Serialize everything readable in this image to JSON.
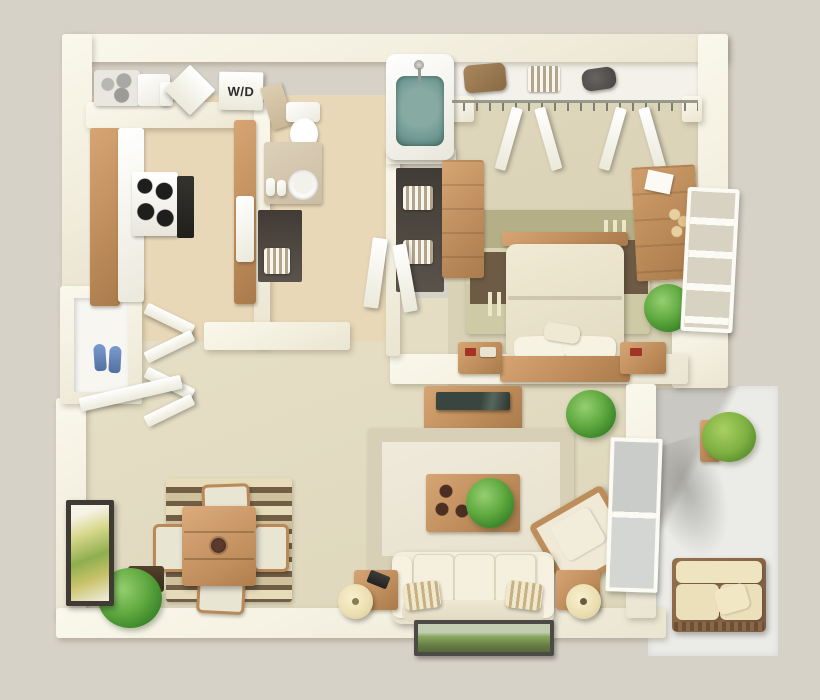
{
  "scene": {
    "title": "One-bedroom apartment 3D floor plan (bird's-eye render)",
    "labels": {
      "washer_dryer": "W/D"
    },
    "palette": {
      "background": "#d7d2c7",
      "wall": "#f5f1e2",
      "tile_floor": "#e9d8b8",
      "carpet_living": "#e4ddc2",
      "carpet_bedroom": "#dcd4b8",
      "closet_floor": "#f3f1e9",
      "balcony_floor": "#ebebe8",
      "wood": "#c08e5c",
      "upholstery_cream": "#f1ebd8",
      "bath_water": "#6f9a93",
      "plant_green": "#5fa83f",
      "rug_olive": "#b4af87",
      "rug_brown": "#6e5b45",
      "rug_cream": "#d9d3b2",
      "shoes_blue": "#5f86c4",
      "tv_screen": "#2f3a35",
      "art_green": "#7e9a55"
    },
    "rooms": [
      {
        "id": "kitchen",
        "name": "galley kitchen"
      },
      {
        "id": "laundry-closet",
        "name": "washer-dryer closet"
      },
      {
        "id": "bathroom",
        "name": "bathroom"
      },
      {
        "id": "bedroom",
        "name": "bedroom"
      },
      {
        "id": "bedroom-closet",
        "name": "bedroom closet"
      },
      {
        "id": "entry",
        "name": "entry hall"
      },
      {
        "id": "dining-area",
        "name": "dining area"
      },
      {
        "id": "living-room",
        "name": "living room"
      },
      {
        "id": "storage-closet",
        "name": "exterior storage closet"
      },
      {
        "id": "balcony",
        "name": "balcony patio"
      }
    ],
    "furniture": {
      "kitchen": [
        "range-with-four-burners",
        "oven-front",
        "wood-base-cabinets-left",
        "wood-base-cabinets-right",
        "white-countertops",
        "shelf-rack",
        "storage-boxes"
      ],
      "bathroom": [
        "bathtub-with-water",
        "toilet",
        "vanity-counter",
        "round-sink",
        "toiletries",
        "linen-shelves-with-striped-towels",
        "medicine-cabinet"
      ],
      "bedroom": [
        "double-bed-cream-duvet",
        "wood-headboard",
        "wood-footboard",
        "two-pillows",
        "accent-pillow",
        "nightstand-left",
        "nightstand-right",
        "tall-chest",
        "dresser-with-paper-and-bottles",
        "striped-area-rug",
        "potted-plant",
        "window-with-blinds",
        "closet-shelf-bag",
        "closet-shelf-towels",
        "closet-dark-object",
        "bifold-closet-doors"
      ],
      "living_room": [
        "cream-sofa",
        "two-striped-throw-pillows",
        "tv-console",
        "flat-tv",
        "coffee-table",
        "coffee-table-plant",
        "coasters",
        "armchair",
        "end-table-left",
        "end-table-right",
        "two-round-lamps",
        "telephone",
        "area-rug",
        "potted-plant-by-window",
        "sliding-window",
        "framed-landscape-art-on-outer-wall"
      ],
      "dining_area": [
        "square-wood-table",
        "center-bowl",
        "four-chairs",
        "striped-brown-rug",
        "potted-plant",
        "framed-botanical-art"
      ],
      "entry": [
        "open-front-door",
        "bifold-closet-doors",
        "blue-shoes-in-storage-closet"
      ],
      "balcony": [
        "outdoor-bench-with-cushions",
        "bench-pillow",
        "potted-plant-on-ledge",
        "plant-shadow"
      ]
    }
  }
}
